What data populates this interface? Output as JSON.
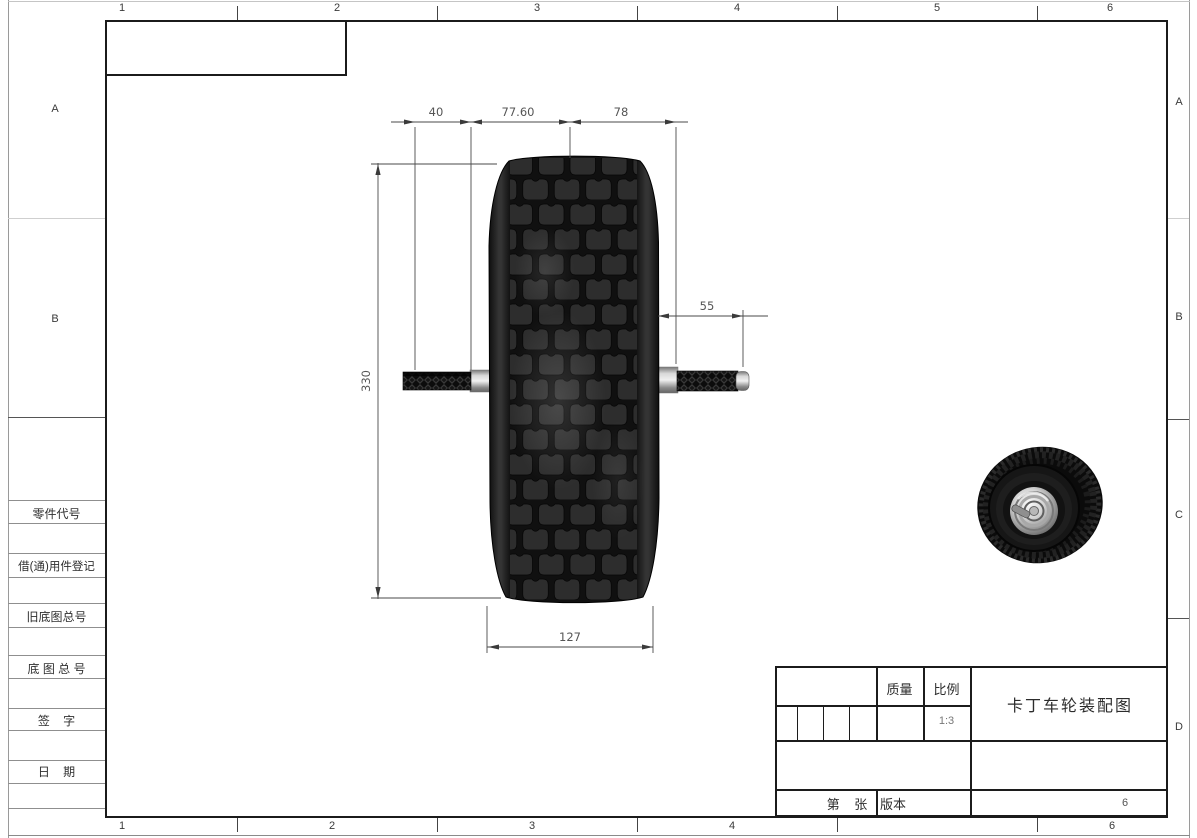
{
  "zones": {
    "top": [
      "1",
      "2",
      "3",
      "4",
      "5",
      "6"
    ],
    "bottom": [
      "1",
      "2",
      "3",
      "4",
      "6"
    ],
    "left": [
      "A",
      "B"
    ],
    "right": [
      "A",
      "B",
      "C",
      "D"
    ]
  },
  "left_panel": {
    "labels": [
      "零件代号",
      "借(通)用件登记",
      "旧底图总号",
      "底 图 总 号",
      "签    字",
      "日    期"
    ]
  },
  "title_block": {
    "mass_label": "质量",
    "scale_label": "比例",
    "scale_value": "1:3",
    "drawing_title": "卡丁车轮装配图",
    "sheet_label": "第    张",
    "version_label": "版本",
    "corner_zone": "6"
  },
  "dims": {
    "top_left": "40",
    "top_mid": "77.60",
    "top_right": "78",
    "height": "330",
    "axle": "55",
    "width": "127"
  },
  "colors": {
    "frame_line": "#1b1b1b",
    "dim_line": "#4a4a4a",
    "dim_text": "#555555",
    "tire_body": "#141414",
    "tread_block": "#2d2d2d"
  }
}
